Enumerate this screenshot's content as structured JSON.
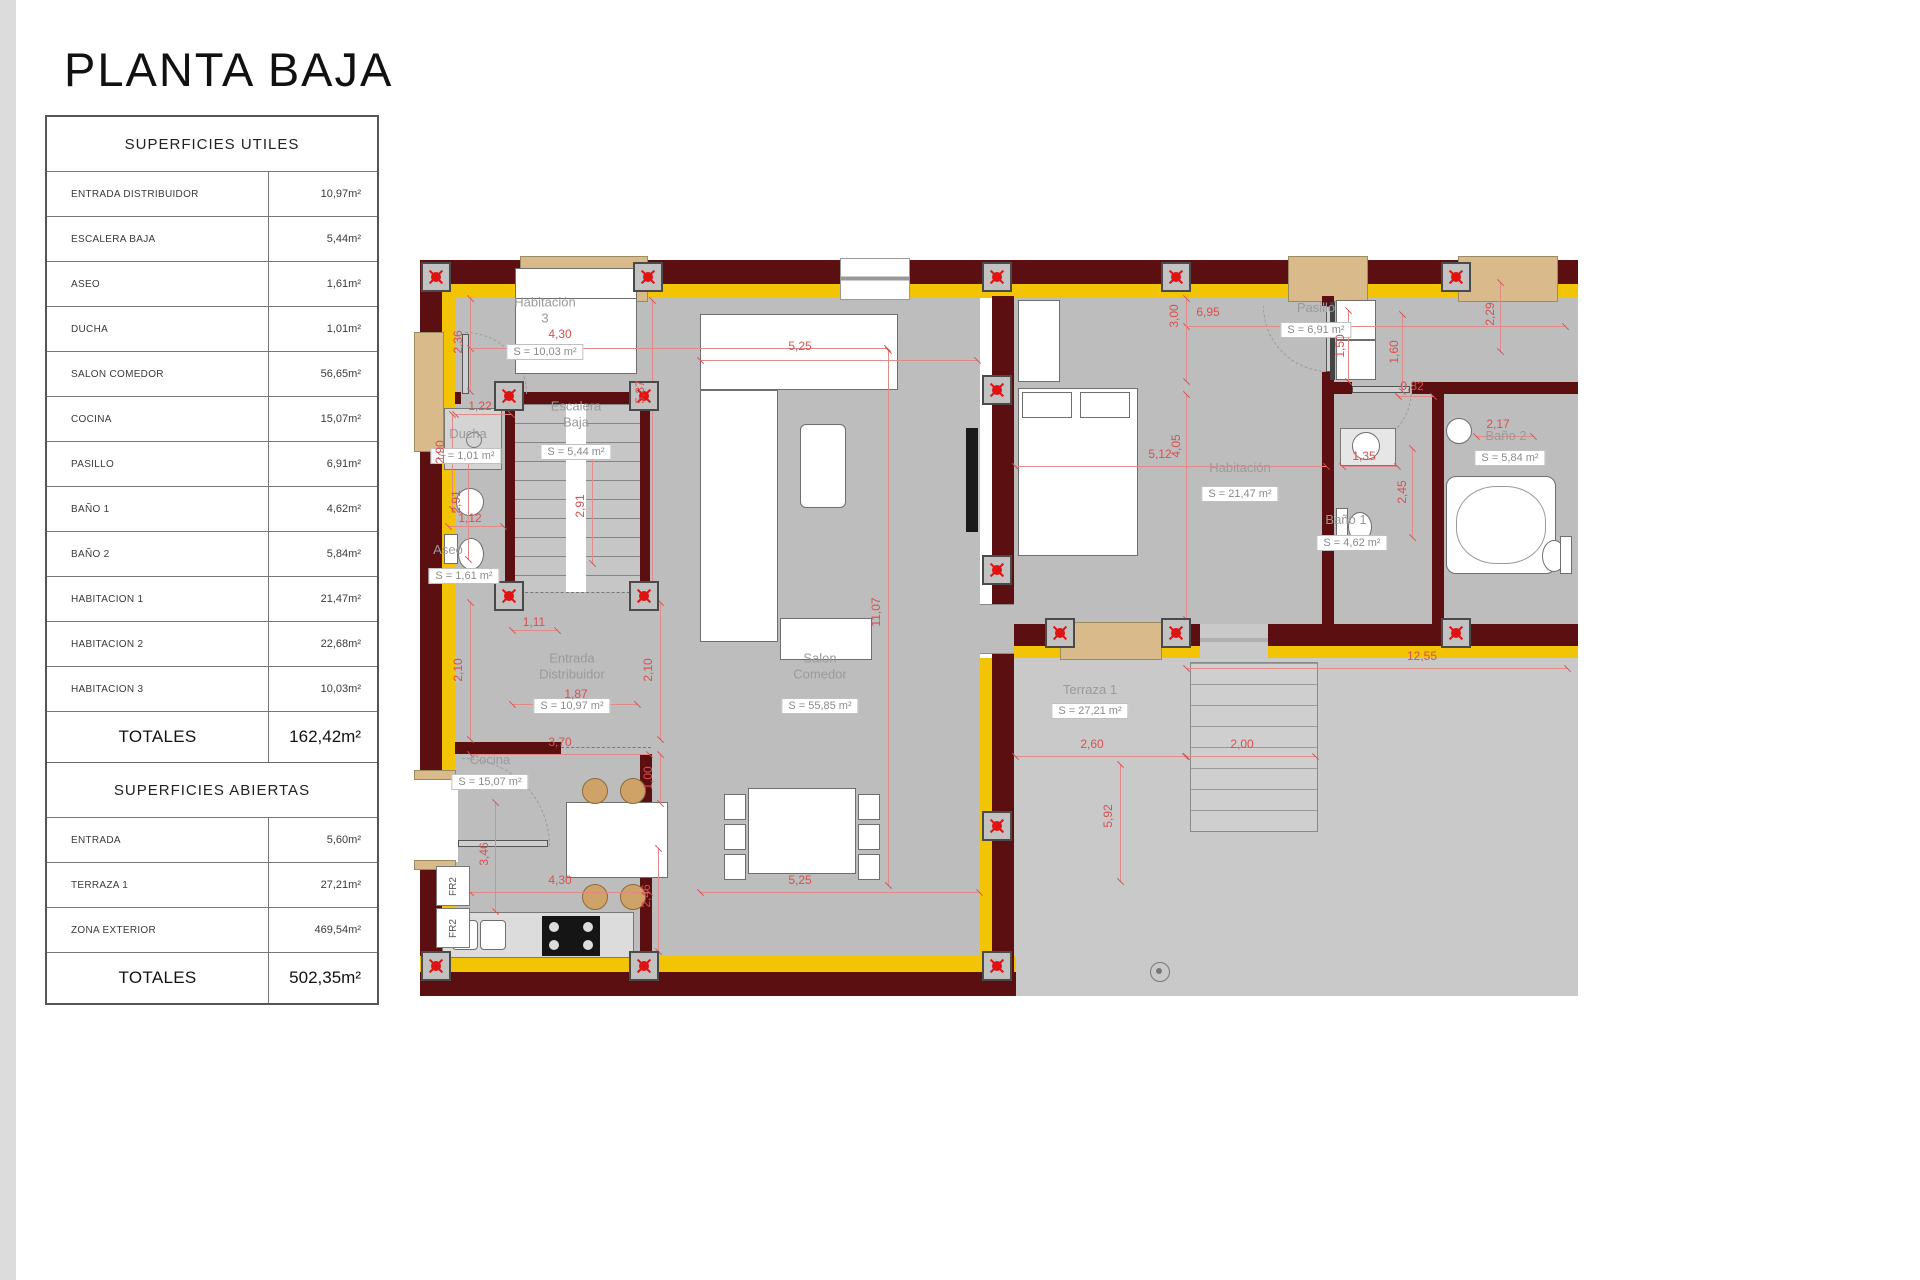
{
  "title": "PLANTA BAJA",
  "table": {
    "header1": "SUPERFICIES UTILES",
    "rows1": [
      [
        "ENTRADA DISTRIBUIDOR",
        "10,97m²"
      ],
      [
        "ESCALERA BAJA",
        "5,44m²"
      ],
      [
        "ASEO",
        "1,61m²"
      ],
      [
        "DUCHA",
        "1,01m²"
      ],
      [
        "SALON COMEDOR",
        "56,65m²"
      ],
      [
        "COCINA",
        "15,07m²"
      ],
      [
        "PASILLO",
        "6,91m²"
      ],
      [
        "BAÑO 1",
        "4,62m²"
      ],
      [
        "BAÑO 2",
        "5,84m²"
      ],
      [
        "HABITACION 1",
        "21,47m²"
      ],
      [
        "HABITACION 2",
        "22,68m²"
      ],
      [
        "HABITACION 3",
        "10,03m²"
      ]
    ],
    "totals1": [
      "TOTALES",
      "162,42m²"
    ],
    "header2": "SUPERFICIES ABIERTAS",
    "rows2": [
      [
        "ENTRADA",
        "5,60m²"
      ],
      [
        "TERRAZA 1",
        "27,21m²"
      ],
      [
        "ZONA EXTERIOR",
        "469,54m²"
      ]
    ],
    "totals2": [
      "TOTALES",
      "502,35m²"
    ]
  },
  "plan": {
    "colors": {
      "wall": "#5c0f10",
      "insulation": "#f2c403",
      "lintel": "#d9bb8b",
      "floor": "#bdbdbd",
      "terrace": "#c9c9c9",
      "dim": "#d94f4f",
      "dim_line": "#e08a8a",
      "pier_dot": "#e01212"
    },
    "rooms": [
      {
        "name": "Habitación\n3",
        "nx": 545,
        "ny": 310,
        "area": "S = 10,03 m²",
        "ax": 545,
        "ay": 352
      },
      {
        "name": "Escalera\nBaja",
        "nx": 576,
        "ny": 414,
        "area": "S = 5,44 m²",
        "ax": 576,
        "ay": 452
      },
      {
        "name": "Ducha",
        "nx": 468,
        "ny": 434,
        "area": "S = 1,01 m²",
        "ax": 466,
        "ay": 456
      },
      {
        "name": "Aseo",
        "nx": 448,
        "ny": 550,
        "area": "S = 1,61 m²",
        "ax": 464,
        "ay": 576
      },
      {
        "name": "Entrada\nDistribuidor",
        "nx": 572,
        "ny": 666,
        "area": "S = 10,97 m²",
        "ax": 572,
        "ay": 706
      },
      {
        "name": "Salon\nComedor",
        "nx": 820,
        "ny": 666,
        "area": "S = 55,85 m²",
        "ax": 820,
        "ay": 706
      },
      {
        "name": "Cocina",
        "nx": 490,
        "ny": 760,
        "area": "S = 15,07 m²",
        "ax": 490,
        "ay": 782
      },
      {
        "name": "Pasillo",
        "nx": 1316,
        "ny": 308,
        "area": "S = 6,91 m²",
        "ax": 1316,
        "ay": 330
      },
      {
        "name": "Habitación",
        "nx": 1240,
        "ny": 468,
        "area": "S = 21,47 m²",
        "ax": 1240,
        "ay": 494
      },
      {
        "name": "Baño 1",
        "nx": 1346,
        "ny": 520,
        "area": "S = 4,62 m²",
        "ax": 1352,
        "ay": 543
      },
      {
        "name": "Baño 2",
        "nx": 1506,
        "ny": 436,
        "area": "S = 5,84 m²",
        "ax": 1510,
        "ay": 458
      },
      {
        "name": "Terraza 1",
        "nx": 1090,
        "ny": 690,
        "area": "S = 27,21 m²",
        "ax": 1090,
        "ay": 711
      }
    ],
    "dims": [
      {
        "t": "4,30",
        "x": 560,
        "y": 334,
        "r": 0
      },
      {
        "t": "2,36",
        "x": 458,
        "y": 342,
        "r": 1
      },
      {
        "t": "5,25",
        "x": 800,
        "y": 346,
        "r": 0
      },
      {
        "t": "5,37",
        "x": 640,
        "y": 392,
        "r": 1
      },
      {
        "t": "1,22",
        "x": 480,
        "y": 406,
        "r": 0
      },
      {
        "t": "2,90",
        "x": 440,
        "y": 452,
        "r": 1
      },
      {
        "t": "6,95",
        "x": 1208,
        "y": 312,
        "r": 0
      },
      {
        "t": "3,00",
        "x": 1174,
        "y": 316,
        "r": 1
      },
      {
        "t": "2,29",
        "x": 1490,
        "y": 314,
        "r": 1
      },
      {
        "t": "1,50",
        "x": 1340,
        "y": 346,
        "r": 1
      },
      {
        "t": "1,60",
        "x": 1394,
        "y": 352,
        "r": 1
      },
      {
        "t": "0,82",
        "x": 1412,
        "y": 386,
        "r": 0
      },
      {
        "t": "2,17",
        "x": 1498,
        "y": 424,
        "r": 0
      },
      {
        "t": "5,12",
        "x": 1160,
        "y": 454,
        "r": 0
      },
      {
        "t": "4,05",
        "x": 1176,
        "y": 446,
        "r": 1
      },
      {
        "t": "1,35",
        "x": 1364,
        "y": 456,
        "r": 0
      },
      {
        "t": "2,45",
        "x": 1402,
        "y": 492,
        "r": 1
      },
      {
        "t": "2,91",
        "x": 456,
        "y": 502,
        "r": 1
      },
      {
        "t": "2,91",
        "x": 580,
        "y": 506,
        "r": 1
      },
      {
        "t": "1,12",
        "x": 470,
        "y": 518,
        "r": 0
      },
      {
        "t": "1,11",
        "x": 534,
        "y": 622,
        "r": 0
      },
      {
        "t": "1,87",
        "x": 576,
        "y": 694,
        "r": 0
      },
      {
        "t": "3,70",
        "x": 560,
        "y": 742,
        "r": 0
      },
      {
        "t": "11,07",
        "x": 876,
        "y": 612,
        "r": 1
      },
      {
        "t": "2,10",
        "x": 458,
        "y": 670,
        "r": 1
      },
      {
        "t": "2,10",
        "x": 648,
        "y": 670,
        "r": 1
      },
      {
        "t": "12,55",
        "x": 1422,
        "y": 656,
        "r": 0
      },
      {
        "t": "2,60",
        "x": 1092,
        "y": 744,
        "r": 0
      },
      {
        "t": "2,00",
        "x": 1242,
        "y": 744,
        "r": 0
      },
      {
        "t": "1,00",
        "x": 648,
        "y": 778,
        "r": 1
      },
      {
        "t": "5,92",
        "x": 1108,
        "y": 816,
        "r": 1
      },
      {
        "t": "3,46",
        "x": 484,
        "y": 854,
        "r": 1
      },
      {
        "t": "4,30",
        "x": 560,
        "y": 880,
        "r": 0
      },
      {
        "t": "2,46",
        "x": 646,
        "y": 896,
        "r": 1
      },
      {
        "t": "5,25",
        "x": 800,
        "y": 880,
        "r": 0
      }
    ],
    "dimlines": [
      {
        "x": 470,
        "y": 348,
        "l": 418,
        "o": "h"
      },
      {
        "x": 470,
        "y": 298,
        "l": 94,
        "o": "v"
      },
      {
        "x": 700,
        "y": 360,
        "l": 278,
        "o": "h"
      },
      {
        "x": 652,
        "y": 300,
        "l": 292,
        "o": "v"
      },
      {
        "x": 455,
        "y": 414,
        "l": 57,
        "o": "h"
      },
      {
        "x": 452,
        "y": 414,
        "l": 96,
        "o": "v"
      },
      {
        "x": 1186,
        "y": 326,
        "l": 380,
        "o": "h"
      },
      {
        "x": 1186,
        "y": 298,
        "l": 84,
        "o": "v"
      },
      {
        "x": 1500,
        "y": 282,
        "l": 70,
        "o": "v"
      },
      {
        "x": 1348,
        "y": 310,
        "l": 72,
        "o": "v"
      },
      {
        "x": 1402,
        "y": 314,
        "l": 78,
        "o": "v"
      },
      {
        "x": 1398,
        "y": 396,
        "l": 36,
        "o": "h"
      },
      {
        "x": 1476,
        "y": 436,
        "l": 58,
        "o": "h"
      },
      {
        "x": 1015,
        "y": 466,
        "l": 312,
        "o": "h"
      },
      {
        "x": 1186,
        "y": 394,
        "l": 226,
        "o": "v"
      },
      {
        "x": 1342,
        "y": 466,
        "l": 56,
        "o": "h"
      },
      {
        "x": 1412,
        "y": 448,
        "l": 90,
        "o": "v"
      },
      {
        "x": 468,
        "y": 452,
        "l": 108,
        "o": "v"
      },
      {
        "x": 592,
        "y": 456,
        "l": 108,
        "o": "v"
      },
      {
        "x": 448,
        "y": 526,
        "l": 56,
        "o": "h"
      },
      {
        "x": 512,
        "y": 630,
        "l": 46,
        "o": "h"
      },
      {
        "x": 512,
        "y": 704,
        "l": 126,
        "o": "h"
      },
      {
        "x": 470,
        "y": 754,
        "l": 180,
        "o": "h"
      },
      {
        "x": 888,
        "y": 350,
        "l": 536,
        "o": "v"
      },
      {
        "x": 470,
        "y": 602,
        "l": 138,
        "o": "v"
      },
      {
        "x": 660,
        "y": 602,
        "l": 138,
        "o": "v"
      },
      {
        "x": 1186,
        "y": 668,
        "l": 382,
        "o": "h"
      },
      {
        "x": 1015,
        "y": 756,
        "l": 171,
        "o": "h"
      },
      {
        "x": 1186,
        "y": 756,
        "l": 130,
        "o": "h"
      },
      {
        "x": 660,
        "y": 754,
        "l": 50,
        "o": "v"
      },
      {
        "x": 1120,
        "y": 764,
        "l": 118,
        "o": "v"
      },
      {
        "x": 495,
        "y": 802,
        "l": 110,
        "o": "v"
      },
      {
        "x": 470,
        "y": 892,
        "l": 180,
        "o": "h"
      },
      {
        "x": 658,
        "y": 848,
        "l": 104,
        "o": "v"
      },
      {
        "x": 700,
        "y": 892,
        "l": 280,
        "o": "h"
      }
    ],
    "piers": [
      [
        436,
        277
      ],
      [
        648,
        277
      ],
      [
        997,
        277
      ],
      [
        1176,
        277
      ],
      [
        1456,
        277
      ],
      [
        509,
        396
      ],
      [
        644,
        396
      ],
      [
        509,
        596
      ],
      [
        644,
        596
      ],
      [
        997,
        390
      ],
      [
        997,
        570
      ],
      [
        997,
        826
      ],
      [
        436,
        966
      ],
      [
        644,
        966
      ],
      [
        997,
        966
      ],
      [
        1060,
        633
      ],
      [
        1176,
        633
      ],
      [
        1456,
        633
      ]
    ],
    "appliance_labels": [
      {
        "t": "FR2",
        "x": 453,
        "y": 886
      },
      {
        "t": "FR2",
        "x": 453,
        "y": 928
      }
    ]
  }
}
